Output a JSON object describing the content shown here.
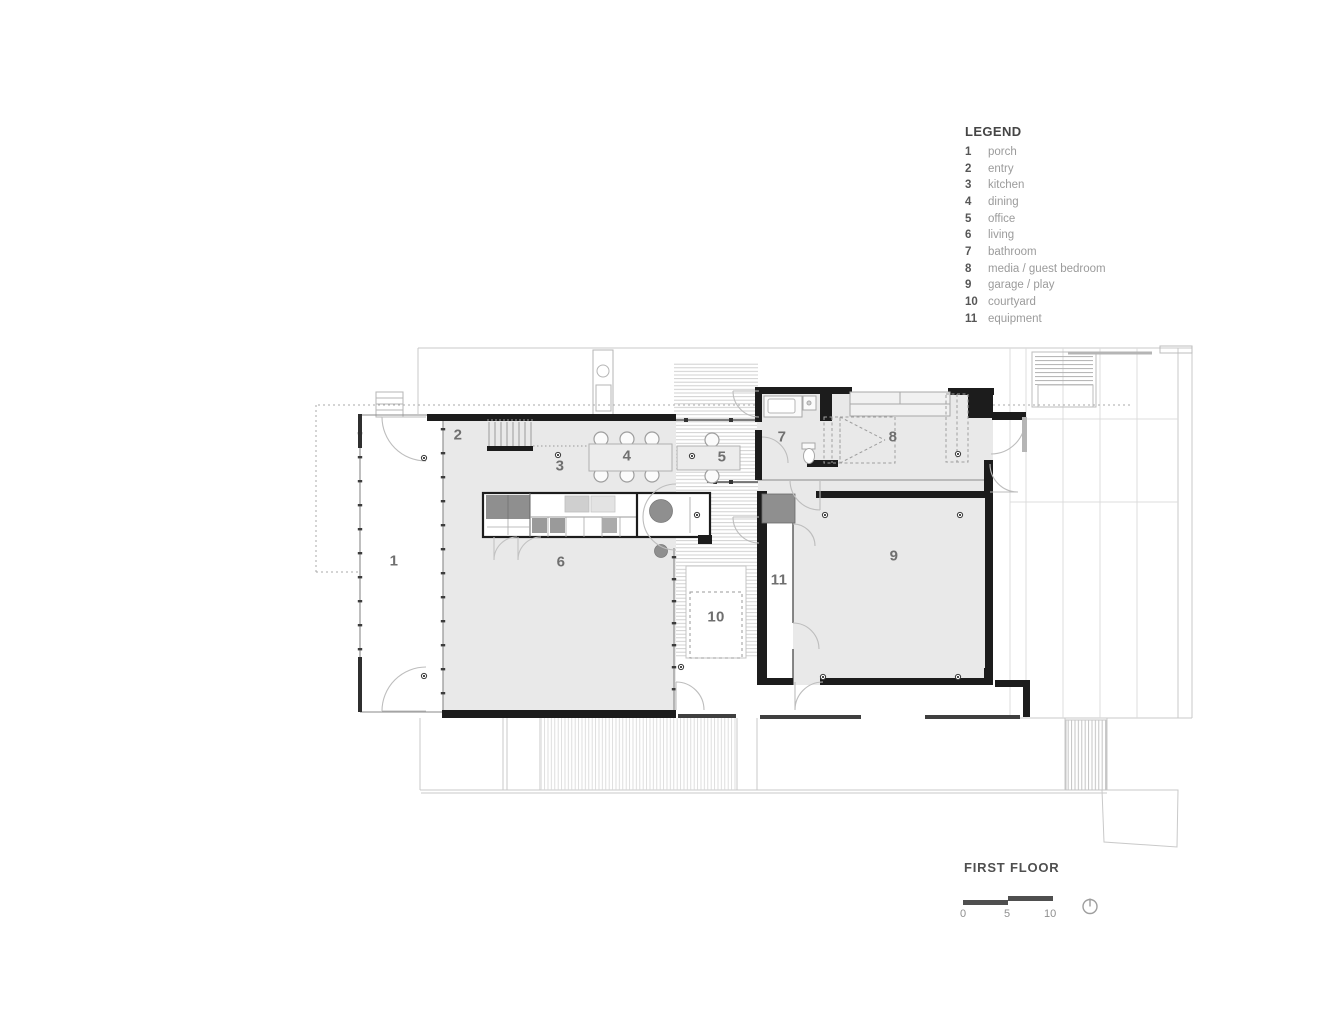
{
  "title": "FIRST FLOOR",
  "legend": {
    "header": "LEGEND",
    "items": [
      {
        "num": "1",
        "label": "porch"
      },
      {
        "num": "2",
        "label": "entry"
      },
      {
        "num": "3",
        "label": "kitchen"
      },
      {
        "num": "4",
        "label": "dining"
      },
      {
        "num": "5",
        "label": "office"
      },
      {
        "num": "6",
        "label": "living"
      },
      {
        "num": "7",
        "label": "bathroom"
      },
      {
        "num": "8",
        "label": "media / guest bedroom"
      },
      {
        "num": "9",
        "label": "garage / play"
      },
      {
        "num": "10",
        "label": "courtyard"
      },
      {
        "num": "11",
        "label": "equipment"
      }
    ]
  },
  "plan": {
    "rooms": [
      {
        "num": "1",
        "name": "porch"
      },
      {
        "num": "2",
        "name": "entry"
      },
      {
        "num": "3",
        "name": "kitchen"
      },
      {
        "num": "4",
        "name": "dining"
      },
      {
        "num": "5",
        "name": "office"
      },
      {
        "num": "6",
        "name": "living"
      },
      {
        "num": "7",
        "name": "bathroom"
      },
      {
        "num": "8",
        "name": "media / guest bedroom"
      },
      {
        "num": "9",
        "name": "garage / play"
      },
      {
        "num": "10",
        "name": "courtyard"
      },
      {
        "num": "11",
        "name": "equipment"
      }
    ]
  },
  "scale_bar": {
    "ticks": [
      "0",
      "5",
      "10"
    ]
  },
  "icons": {
    "north_arrow": "north-arrow"
  },
  "colors": {
    "wall": "#1c1c1c",
    "floor_fill": "#e9e9e9",
    "equipment_fill": "#8f8f8f",
    "line_light": "#c9c9c9",
    "room_label": "#6f6f6f",
    "legend_number": "#565656",
    "legend_label": "#9b9b9b",
    "title_text": "#4f4f4f",
    "scale_bar": "#4f4f4f"
  }
}
